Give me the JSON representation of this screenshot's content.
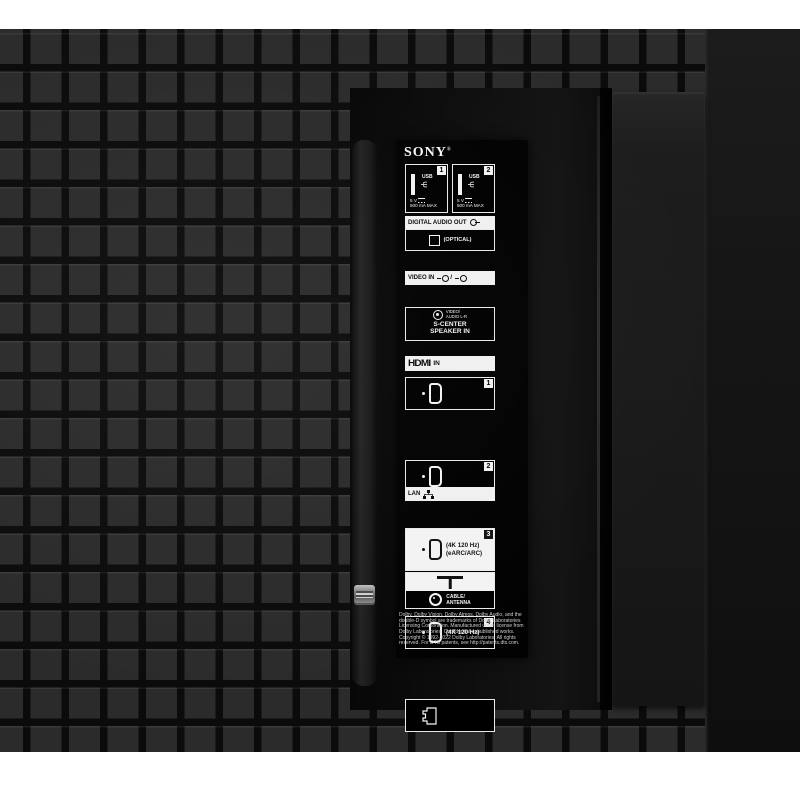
{
  "panel": {
    "brand": "SONY",
    "brand_reg": "®",
    "usb": {
      "ports": [
        {
          "tag": "1",
          "label": "USB",
          "power": "5 V",
          "current": "500 mA MAX"
        },
        {
          "tag": "2",
          "label": "USB",
          "power": "5 V",
          "current": "500 mA MAX"
        }
      ]
    },
    "digital_audio_out": {
      "header": "DIGITAL AUDIO OUT",
      "optical": "(OPTICAL)"
    },
    "video_in": {
      "header": "VIDEO IN",
      "slash": "/",
      "jack_label1": "VIDEO/",
      "jack_label2": "AUDIO L-R",
      "scenter1": "S-CENTER",
      "scenter2": "SPEAKER IN",
      "hdmi1_tag": "1"
    },
    "hdmi_in": {
      "logo": "HDMI",
      "suffix": "IN",
      "port2_tag": "2",
      "port3_tag": "3",
      "port3_line1": "(4K 120 Hz)",
      "port3_line2": "(eARC/ARC)",
      "port4_tag": "4",
      "port4_line1": "(4K 120 Hz)"
    },
    "lan": {
      "header": "LAN"
    },
    "cable_antenna": {
      "line1": "CABLE/",
      "line2": "ANTENNA"
    },
    "legal": "Dolby, Dolby Vision, Dolby Atmos, Dolby Audio, and the double-D symbol are trademarks of Dolby Laboratories Licensing Corporation. Manufactured under license from Dolby Laboratories. Confidential unpublished works. Copyright © 1992-2022 Dolby Laboratories. All rights reserved. For DTS patents, see http://patents.dts.com."
  },
  "colors": {
    "background": "#ffffff",
    "tile": "#2b2b2b",
    "tile_gap": "#0b0b0b",
    "plate": "#020202",
    "label_white": "#f2f2f2",
    "latch_metal": "#9b9b9b"
  }
}
